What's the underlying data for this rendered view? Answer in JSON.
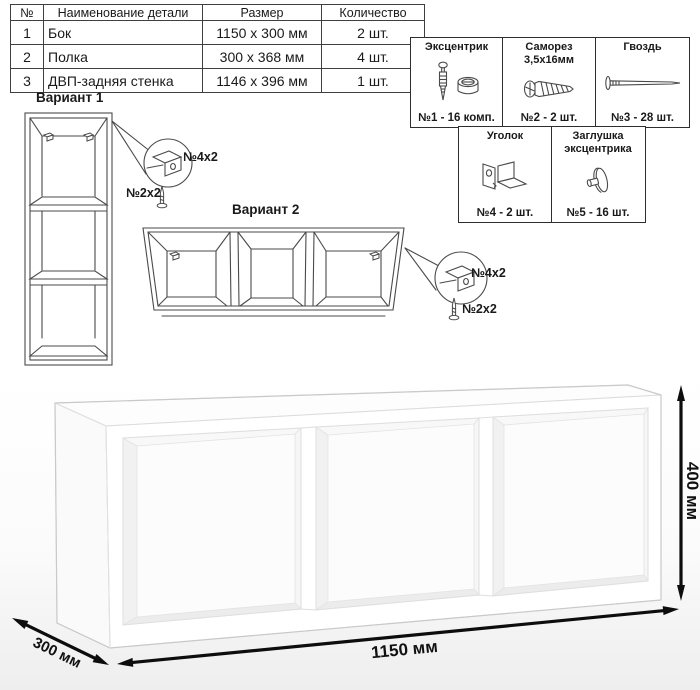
{
  "table": {
    "headers": [
      "№",
      "Наименование детали",
      "Размер",
      "Количество"
    ],
    "rows": [
      [
        "1",
        "Бок",
        "1150 x 300 мм",
        "2 шт."
      ],
      [
        "2",
        "Полка",
        "300 x 368 мм",
        "4 шт."
      ],
      [
        "3",
        "ДВП-задняя стенка",
        "1146 x 396 мм",
        "1 шт."
      ]
    ]
  },
  "hardware": {
    "items": [
      {
        "title": "Эксцентрик",
        "subtitle": "",
        "count": "№1 - 16 комп.",
        "icon": "eccentric-icon"
      },
      {
        "title": "Саморез",
        "subtitle": "3,5х16мм",
        "count": "№2 - 2 шт.",
        "icon": "screw-icon"
      },
      {
        "title": "Гвоздь",
        "subtitle": "",
        "count": "№3 - 28 шт.",
        "icon": "nail-icon"
      },
      {
        "title": "Уголок",
        "subtitle": "",
        "count": "№4 - 2 шт.",
        "icon": "corner-bracket-icon"
      },
      {
        "title": "Заглушка",
        "subtitle": "эксцентрика",
        "count": "№5 - 16 шт.",
        "icon": "cam-cap-icon"
      }
    ]
  },
  "variants": [
    {
      "title": "Вариант 1",
      "bracket_label": "№4х2",
      "screw_label": "№2х2"
    },
    {
      "title": "Вариант 2",
      "bracket_label": "№4х2",
      "screw_label": "№2х2"
    }
  ],
  "dimensions": {
    "width": "1150 мм",
    "height": "400 мм",
    "depth": "300 мм"
  },
  "colors": {
    "line": "#4a4a4a",
    "dimension": "#111111",
    "shade": "#ededed"
  }
}
